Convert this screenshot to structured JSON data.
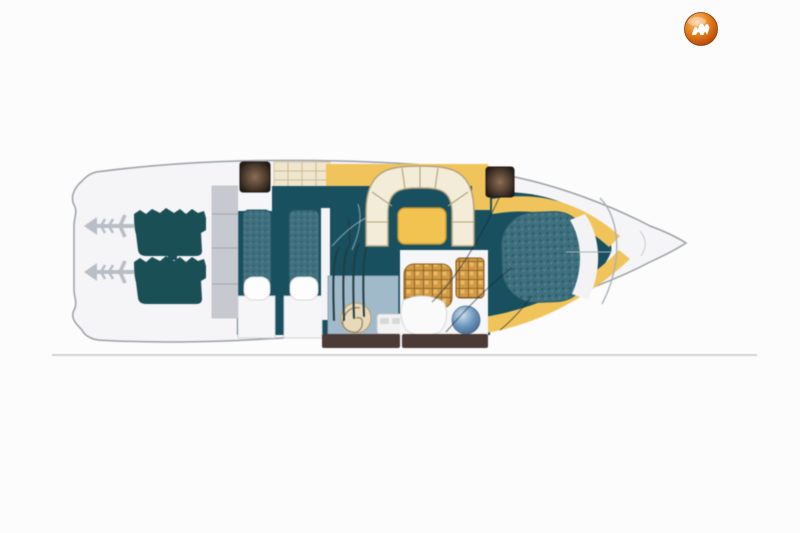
{
  "page": {
    "background": "#fcfcfc"
  },
  "watermark_logo": {
    "icon": "orange-sphere-wave-logo-icon",
    "sphere_color": "#e0741b",
    "rim_color": "#a84208",
    "highlight_color": "#fac892",
    "glyph_color": "#ffffff"
  },
  "floorplan": {
    "diagram_type": "motor-yacht-interior-deck-plan-top-view",
    "orientation": "bow-right-stern-left",
    "features": [
      "twin-engines-with-propeller-shafts",
      "engine-room-bulkhead-steps",
      "aft-deck-hatch",
      "companionway-steps",
      "twin-berth-guest-cabin",
      "u-shaped-dinette-settee-with-table",
      "galley-with-shell-sink-and-stove",
      "staircase-railing",
      "head-with-toilet-washbasin-and-wicker-panels",
      "foredeck-hatch",
      "owners-cabin-island-bed",
      "bow-anchor-locker",
      "waterline-baseline"
    ],
    "colors": {
      "hull_fill": "#f5f5f7",
      "hull_stroke": "#9aa0a6",
      "floor_teal": "#19505f",
      "engine_teal": "#1b4f55",
      "mattress_teal": "#41707e",
      "accent_yellow": "#f0c45e",
      "settee_cream": "#f3ecd9",
      "settee_outline": "#b3a17d",
      "table_yellow": "#f2c355",
      "steps_cream": "#efe6cf",
      "galley_blue": "#a2bac9",
      "counter_brown": "#4c3a36",
      "wicker_tan": "#cf9a4a",
      "wicker_line": "#8a5a1e",
      "basin_blue": "#5f8cb4",
      "prop_gray": "#b9bec6",
      "band_gray": "#c6cad0",
      "room_white": "#f6f6f8",
      "baseline_gray": "#c6c6c6"
    }
  }
}
